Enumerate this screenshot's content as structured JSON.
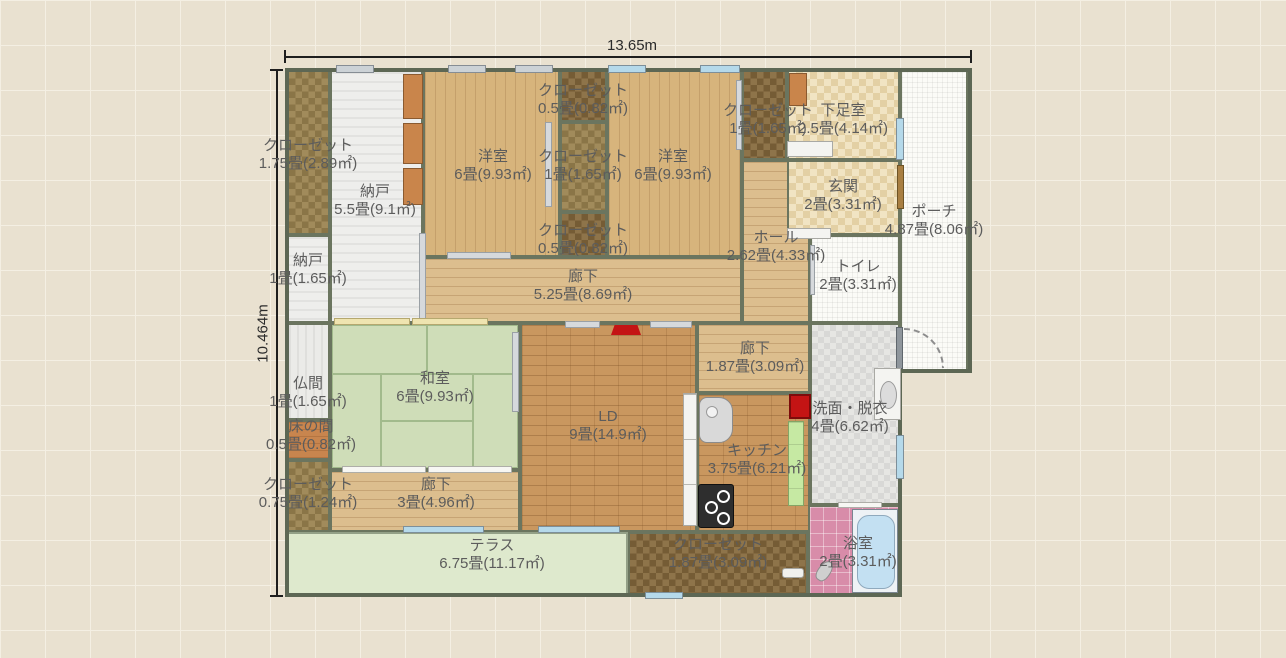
{
  "app": {
    "view": "floor-plan-canvas"
  },
  "dimensions": {
    "width": "13.65m",
    "height": "10.464m"
  },
  "rooms": [
    {
      "name": "クローゼット",
      "size": "1.75畳(2.89㎡)"
    },
    {
      "name": "納戸",
      "size": "5.5畳(9.1㎡)"
    },
    {
      "name": "クローゼット",
      "size": "0.5畳(0.82㎡)"
    },
    {
      "name": "洋室",
      "size": "6畳(9.93㎡)"
    },
    {
      "name": "クローゼット",
      "size": "1畳(1.65㎡)"
    },
    {
      "name": "洋室",
      "size": "6畳(9.93㎡)"
    },
    {
      "name": "クローゼット",
      "size": "0.5畳(0.82㎡)"
    },
    {
      "name": "クローゼット",
      "size": "1畳(1.65㎡)"
    },
    {
      "name": "下足室",
      "size": "2.5畳(4.14㎡)"
    },
    {
      "name": "玄関",
      "size": "2畳(3.31㎡)"
    },
    {
      "name": "ポーチ",
      "size": "4.87畳(8.06㎡)"
    },
    {
      "name": "ホール",
      "size": "2.62畳(4.33㎡)"
    },
    {
      "name": "トイレ",
      "size": "2畳(3.31㎡)"
    },
    {
      "name": "納戸",
      "size": "1畳(1.65㎡)"
    },
    {
      "name": "廊下",
      "size": "5.25畳(8.69㎡)"
    },
    {
      "name": "仏間",
      "size": "1畳(1.65㎡)"
    },
    {
      "name": "和室",
      "size": "6畳(9.93㎡)"
    },
    {
      "name": "LD",
      "size": "9畳(14.9㎡)"
    },
    {
      "name": "廊下",
      "size": "1.87畳(3.09㎡)"
    },
    {
      "name": "洗面・脱衣",
      "size": "4畳(6.62㎡)"
    },
    {
      "name": "床の間",
      "size": "0.5畳(0.82㎡)"
    },
    {
      "name": "クローゼット",
      "size": "0.75畳(1.24㎡)"
    },
    {
      "name": "廊下",
      "size": "3畳(4.96㎡)"
    },
    {
      "name": "キッチン",
      "size": "3.75畳(6.21㎡)"
    },
    {
      "name": "クローゼット",
      "size": "1.87畳(3.09㎡)"
    },
    {
      "name": "浴室",
      "size": "2畳(3.31㎡)"
    },
    {
      "name": "テラス",
      "size": "6.75畳(11.17㎡)"
    }
  ],
  "icons": {
    "shelf": "shelf-icon",
    "sink": "sink-icon",
    "stove": "stove-icon",
    "fridge": "fridge-icon",
    "bathtub": "bathtub-icon",
    "washbasin": "washbasin-icon",
    "shower": "shower-icon",
    "tv": "tv-icon",
    "door_swing": "door-swing-icon",
    "window": "window-icon",
    "sliding_door": "sliding-door-icon"
  },
  "colors": {
    "wall": "#5d6754",
    "tatami": "#cedcb6",
    "ld_brick": "#c9975f",
    "terrace": "#dee9cd",
    "bath_pink": "#d88ca9",
    "window_blue": "#b5d9ea",
    "fridge_red": "#c41414",
    "shelf_orange": "#c9854b",
    "shelf_green": "#c6e9a3",
    "background": "#e9e1d0"
  }
}
